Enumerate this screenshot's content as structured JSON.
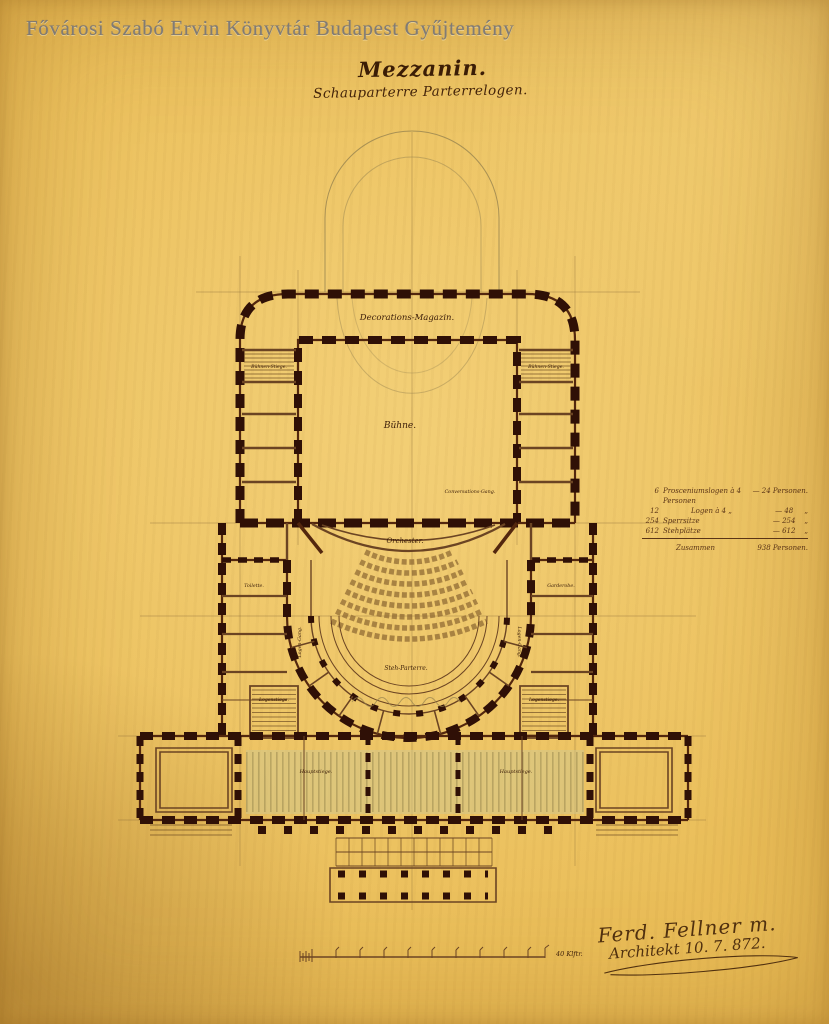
{
  "watermark": "Fővárosi Szabó Ervin Könyvtár Budapest Gyűjtemény",
  "title": "Mezzanin.",
  "subtitle": "Schauparterre Parterrelogen.",
  "plan": {
    "labels": {
      "decorations_magazin": "Decorations-Magazin.",
      "buehne": "Bühne.",
      "orchester": "Orchester.",
      "conversations_gang": "Conversations-Gang.",
      "steh_parterre": "Steh-Parterre.",
      "buehnen_stiege_left": "Bühnen-Stiege.",
      "buehnen_stiege_right": "Bühnen-Stiege.",
      "logen_gang_left": "Logen-Gang.",
      "logen_gang_right": "Logen-Gang.",
      "toilette_left": "Toilette.",
      "garderobe_right": "Garderobe.",
      "logenstiege_left": "Logenstiege.",
      "logenstiege_right": "Logenstiege.",
      "hauptstiege_left": "Hauptstiege.",
      "hauptstiege_right": "Hauptstiege."
    }
  },
  "legend": {
    "rows": [
      {
        "count": "6",
        "item": "Prosceniumslogen à 4 Personen",
        "total": "— 24 Personen."
      },
      {
        "count": "12",
        "item": "Logen à 4   „",
        "total": "— 48     „"
      },
      {
        "count": "254",
        "item": "Sperrsitze",
        "total": "— 254    „"
      },
      {
        "count": "612",
        "item": "Stehplätze",
        "total": "— 612    „"
      }
    ],
    "sum_label": "Zusammen",
    "sum_value": "938 Personen."
  },
  "scale": {
    "label": "40 Klftr."
  },
  "signature": {
    "line1": "Ferd. Fellner m.",
    "line2": "Architekt 10. 7. 872."
  },
  "colors": {
    "paper": "#e8ba52",
    "ink": "#2f1006",
    "line": "#6b4423",
    "pencil": "#97834f",
    "tint": "#cfc88f",
    "watermark_gray": "#74747a"
  }
}
